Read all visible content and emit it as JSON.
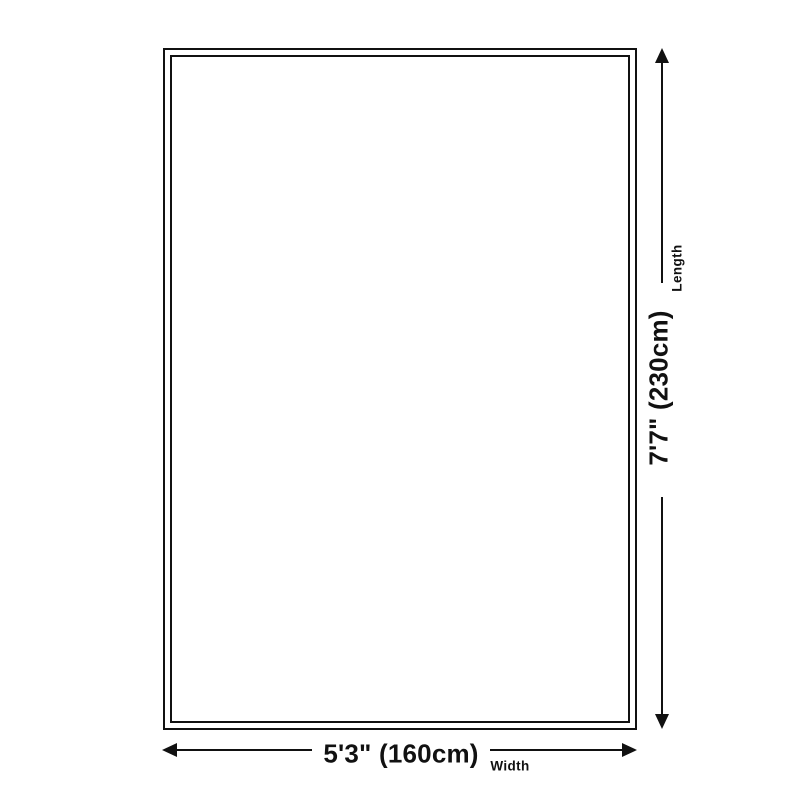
{
  "diagram": {
    "type": "product-size-diagram",
    "shape": "rug-rectangle",
    "background_color": "#ffffff",
    "line_color": "#111111",
    "text_color": "#111111",
    "length": {
      "label": "Length",
      "value": "7'7\" (230cm)"
    },
    "width": {
      "label": "Width",
      "value": "5'3\" (160cm)"
    }
  }
}
